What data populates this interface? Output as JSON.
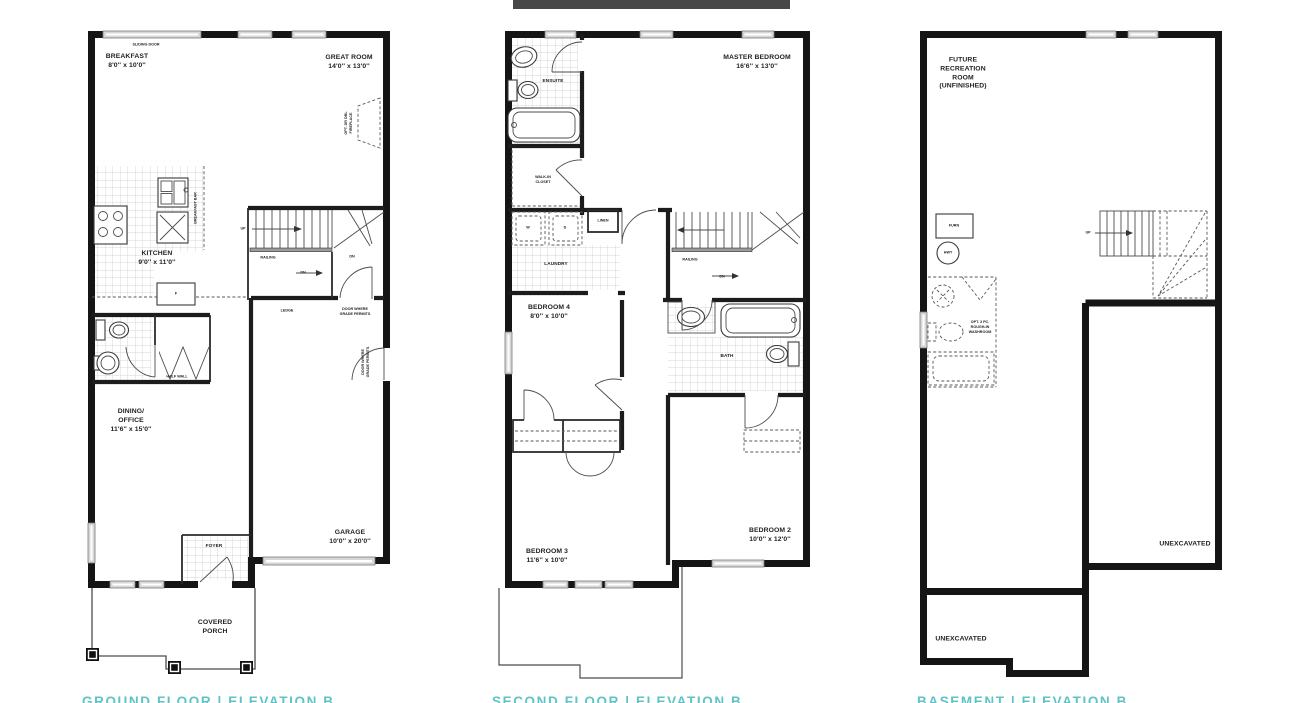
{
  "page": {
    "background": "#ffffff",
    "caption_color": "#5fc3c5",
    "ink_color": "#1c1c1c"
  },
  "plans": {
    "ground": {
      "caption": "GROUND FLOOR  |  ELEVATION B",
      "rooms": {
        "breakfast": "BREAKFAST\n8'0'' x 10'0''",
        "great_room": "GREAT ROOM\n14'0'' x 13'0''",
        "kitchen": "KITCHEN\n9'0'' x 11'0''",
        "dining_office": "DINING/\nOFFICE\n11'6'' x 15'0''",
        "garage": "GARAGE\n10'0'' x 20'0''",
        "foyer": "FOYER",
        "covered_porch": "COVERED\nPORCH"
      },
      "annotations": {
        "sliding_door": "SLIDING DOOR",
        "fireplace": "OPT. DR DBL\nFIREPLACE",
        "breakfast_bar": "BREAKFAST BAR",
        "up": "UP",
        "railing": "RAILING",
        "dn_upper": "DN",
        "dn_lower": "DN",
        "ledge": "LEDGE",
        "door_grade_top": "DOOR WHERE\nGRADE PERMITS",
        "door_grade_side": "DOOR WHERE\nGRADE PERMITS",
        "half_wall": "HALF WALL",
        "fridge": "F"
      }
    },
    "second": {
      "caption": "SECOND FLOOR  |  ELEVATION B",
      "rooms": {
        "master_bedroom": "MASTER BEDROOM\n16'6'' x 13'0''",
        "ensuite": "ENSUITE",
        "walk_in_closet": "WALK-IN\nCLOSET",
        "laundry": "LAUNDRY",
        "bath": "BATH",
        "bedroom4": "BEDROOM 4\n8'0'' x 10'0''",
        "bedroom3": "BEDROOM 3\n11'6'' x 10'0''",
        "bedroom2": "BEDROOM 2\n10'0'' x 12'0''"
      },
      "annotations": {
        "washer": "W",
        "dryer": "D",
        "linen": "LINEN",
        "railing": "RAILING",
        "dn": "DN"
      }
    },
    "basement": {
      "caption": "BASEMENT  |  ELEVATION B",
      "rooms": {
        "future_rec": "FUTURE\nRECREATION\nROOM\n(UNFINISHED)",
        "unexcavated_right": "UNEXCAVATED",
        "unexcavated_bottom": "UNEXCAVATED"
      },
      "annotations": {
        "furnace": "FURN",
        "water_heater": "HWT",
        "up": "UP",
        "opt_washroom": "OPT. 3 PC.\nROUGH-IN\nWASHROOM"
      }
    }
  }
}
